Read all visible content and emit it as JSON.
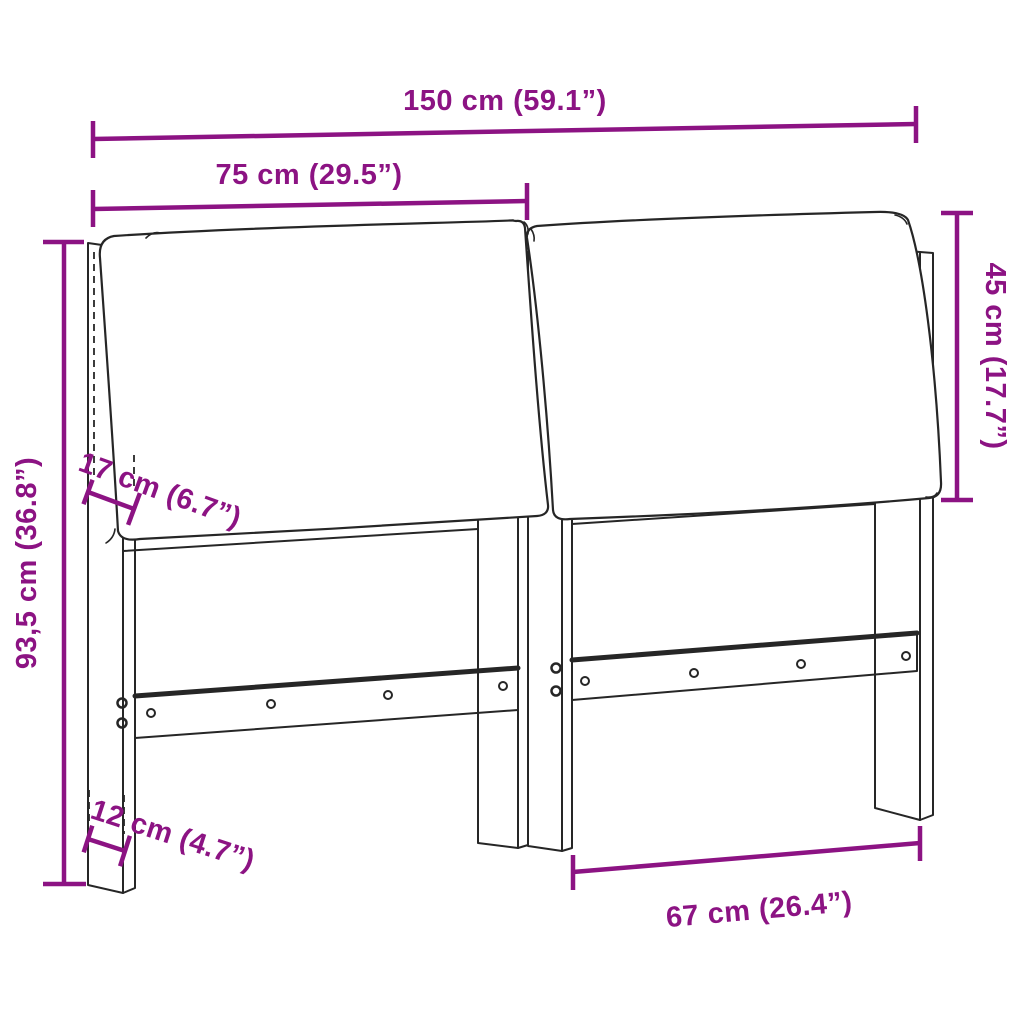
{
  "colors": {
    "accent": "#8C1383",
    "line": "#262626",
    "background": "#ffffff"
  },
  "diagram": {
    "subject": "headboard with two tilted cushions, four legs and horizontal rails with screws",
    "style": "black line drawing with magenta dimension annotations on white background"
  },
  "dims": {
    "total_width": "150 cm (59.1”)",
    "half_width": "75 cm (29.5”)",
    "cushion_height": "45 cm (17.7”)",
    "total_height": "93,5 cm (36.8”)",
    "cushion_thickness": "17 cm (6.7”)",
    "leg_depth": "12 cm (4.7”)",
    "leg_span": "67 cm (26.4”)"
  }
}
